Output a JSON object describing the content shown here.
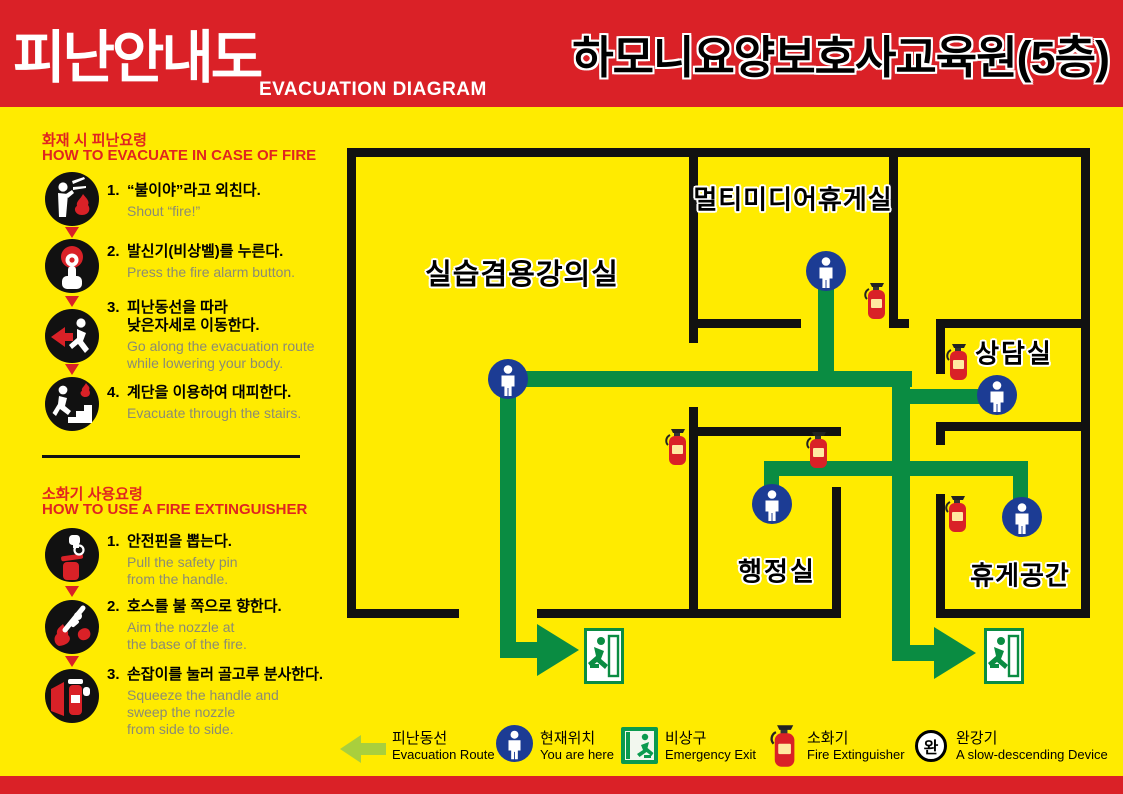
{
  "header": {
    "title_ko": "피난안내도",
    "title_en": "EVACUATION DIAGRAM",
    "building": "하모니요양보호사교육원(5층)"
  },
  "fire_guide": {
    "heading_ko": "화재 시 피난요령",
    "heading_en": "HOW TO EVACUATE IN CASE OF FIRE",
    "steps": [
      {
        "num": "1.",
        "ko": "“불이야”라고 외친다.",
        "en": "Shout “fire!”",
        "icon": "shout-fire-icon"
      },
      {
        "num": "2.",
        "ko": "발신기(비상벨)를 누른다.",
        "en": "Press the fire alarm button.",
        "icon": "press-alarm-icon"
      },
      {
        "num": "3.",
        "ko": "피난동선을 따라\n낮은자세로 이동한다.",
        "en": "Go along the evacuation route\nwhile lowering your body.",
        "icon": "crouch-run-icon"
      },
      {
        "num": "4.",
        "ko": "계단을 이용하여 대피한다.",
        "en": "Evacuate through the stairs.",
        "icon": "stairs-down-icon"
      }
    ]
  },
  "extinguisher_guide": {
    "heading_ko": "소화기 사용요령",
    "heading_en": "HOW TO USE A FIRE EXTINGUISHER",
    "steps": [
      {
        "num": "1.",
        "ko": "안전핀을 뽑는다.",
        "en": "Pull the safety pin\nfrom the handle.",
        "icon": "pull-pin-icon"
      },
      {
        "num": "2.",
        "ko": "호스를 불 쪽으로 향한다.",
        "en": "Aim the nozzle at\nthe base of the fire.",
        "icon": "aim-nozzle-icon"
      },
      {
        "num": "3.",
        "ko": "손잡이를 눌러 골고루 분사한다.",
        "en": "Squeeze the handle and\nsweep the nozzle\nfrom side to side.",
        "icon": "squeeze-sweep-icon"
      }
    ]
  },
  "floor_plan": {
    "rooms": [
      {
        "name": "실습겸용강의실"
      },
      {
        "name": "멀티미디어휴게실"
      },
      {
        "name": "상담실"
      },
      {
        "name": "행정실"
      },
      {
        "name": "휴게공간"
      }
    ]
  },
  "legend": {
    "items": [
      {
        "ko": "피난동선",
        "en": "Evacuation Route",
        "icon": "route-arrow-icon"
      },
      {
        "ko": "현재위치",
        "en": "You are here",
        "icon": "you-are-here-icon"
      },
      {
        "ko": "비상구",
        "en": "Emergency Exit",
        "icon": "emergency-exit-icon"
      },
      {
        "ko": "소화기",
        "en": "Fire Extinguisher",
        "icon": "fire-extinguisher-icon"
      },
      {
        "ko": "완강기",
        "en": "A slow-descending Device",
        "icon": "descending-device-icon",
        "symbol": "완"
      }
    ]
  },
  "colors": {
    "header_red": "#da2127",
    "bg_yellow": "#ffeb00",
    "route_green": "#0a8c42",
    "legend_arrow_green": "#a9cf3d",
    "location_blue": "#1c3c94",
    "wall_black": "#111111",
    "extinguisher_red": "#d92127"
  }
}
